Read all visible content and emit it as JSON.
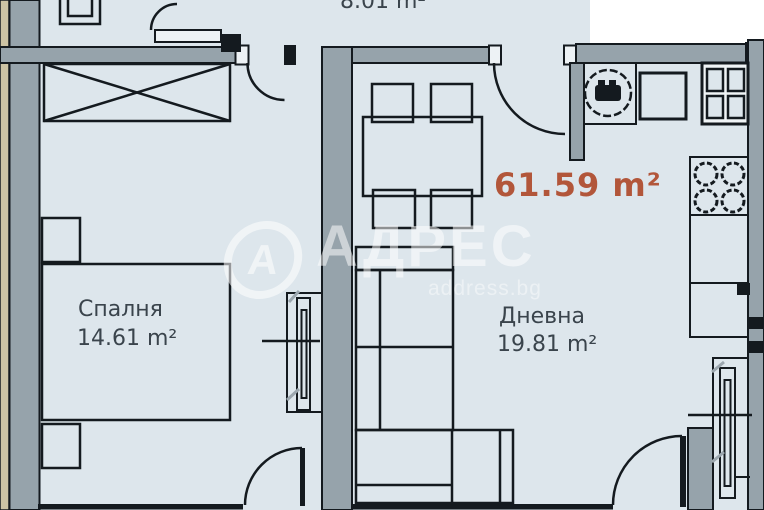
{
  "floor_plan": {
    "total_area": "61.59 m²",
    "hall_area": "8.01 m²",
    "rooms": {
      "bedroom": {
        "name": "Спалня",
        "area": "14.61 m²"
      },
      "living": {
        "name": "Дневна",
        "area": "19.81 m²"
      }
    },
    "watermark": {
      "logo_letter": "А",
      "brand": "АДРЕС",
      "site": "address.bg"
    },
    "colors": {
      "floor_fill": "#dde6ec",
      "wall_fill": "#96a3ab",
      "outer_strip_tan": "#ccc3a4",
      "line_black": "#141a1f",
      "label_text": "#3a444c",
      "total_area_text": "#b2563a",
      "watermark_white": "#ffffff"
    }
  }
}
